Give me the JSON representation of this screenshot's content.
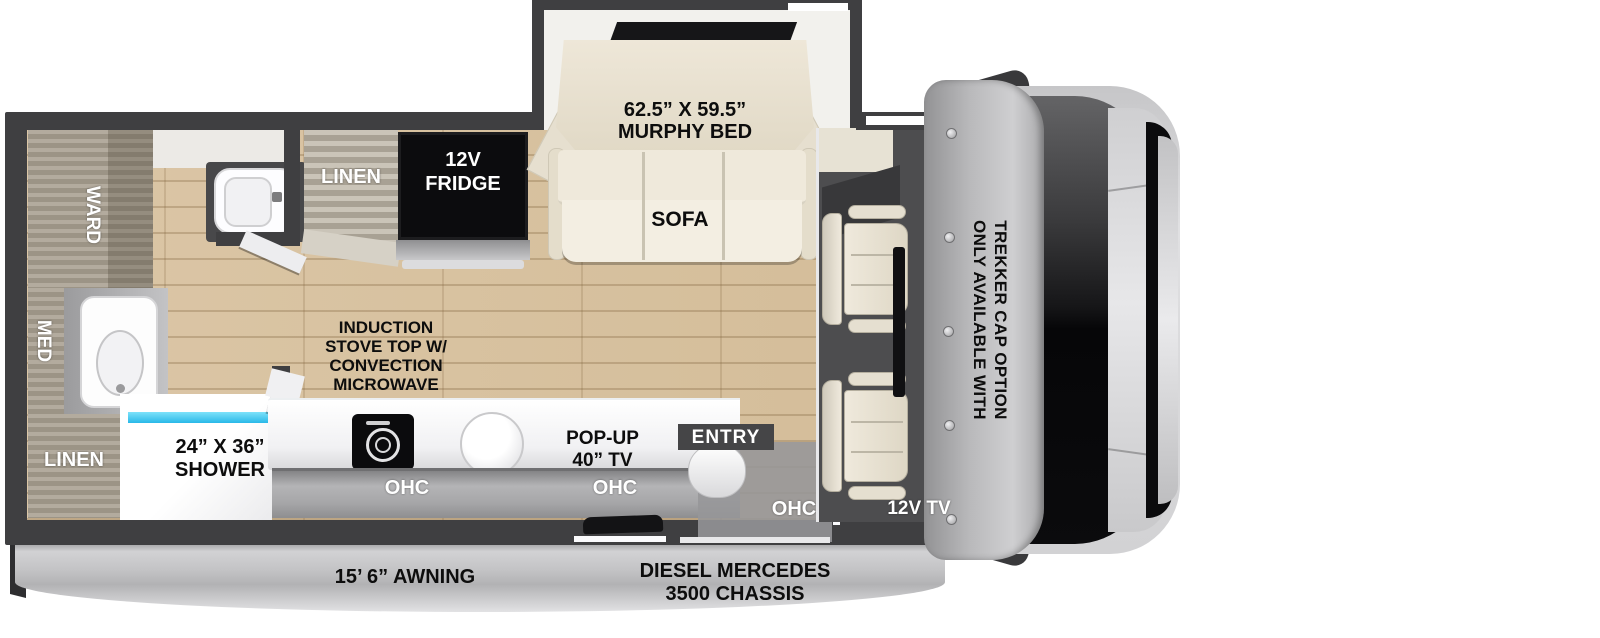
{
  "title": "RV floor plan — murphy bed sofa, diesel Mercedes 3500 chassis",
  "labels": {
    "ward": "WARD",
    "med": "MED",
    "linen_bath": "LINEN",
    "shower_size": "24” X 36”",
    "shower_name": "SHOWER",
    "linen_kitchen": "LINEN",
    "fridge_l1": "12V",
    "fridge_l2": "FRIDGE",
    "stove_l1": "INDUCTION",
    "stove_l2": "STOVE TOP W/",
    "stove_l3": "CONVECTION",
    "stove_l4": "MICROWAVE",
    "murphy_l1": "62.5” X 59.5”",
    "murphy_l2": "MURPHY BED",
    "sofa": "SOFA",
    "popup_l1": "POP-UP",
    "popup_l2": "40” TV",
    "entry": "ENTRY",
    "ohc_left": "OHC",
    "ohc_center": "OHC",
    "ohc_right": "OHC",
    "tv_12v": "12V TV",
    "trekker_l1": "ONLY AVAILABLE WITH",
    "trekker_l2": "TREKKER CAP OPTION",
    "awning": "15’ 6” AWNING",
    "chassis_l1": "DIESEL MERCEDES",
    "chassis_l2": "3500 CHASSIS"
  },
  "colors": {
    "wall_dark": "#3f3f41",
    "floor_wood": "#d8c3a1",
    "cabinet_grain": "#a39b8d",
    "cream_furniture": "#ece5d6",
    "fridge_black": "#0c0c0e",
    "shower_glass_cyan": "#3ec8f0",
    "awning_silver": "#c6c6c8",
    "cab_floor_gray": "#4d4d4f"
  }
}
